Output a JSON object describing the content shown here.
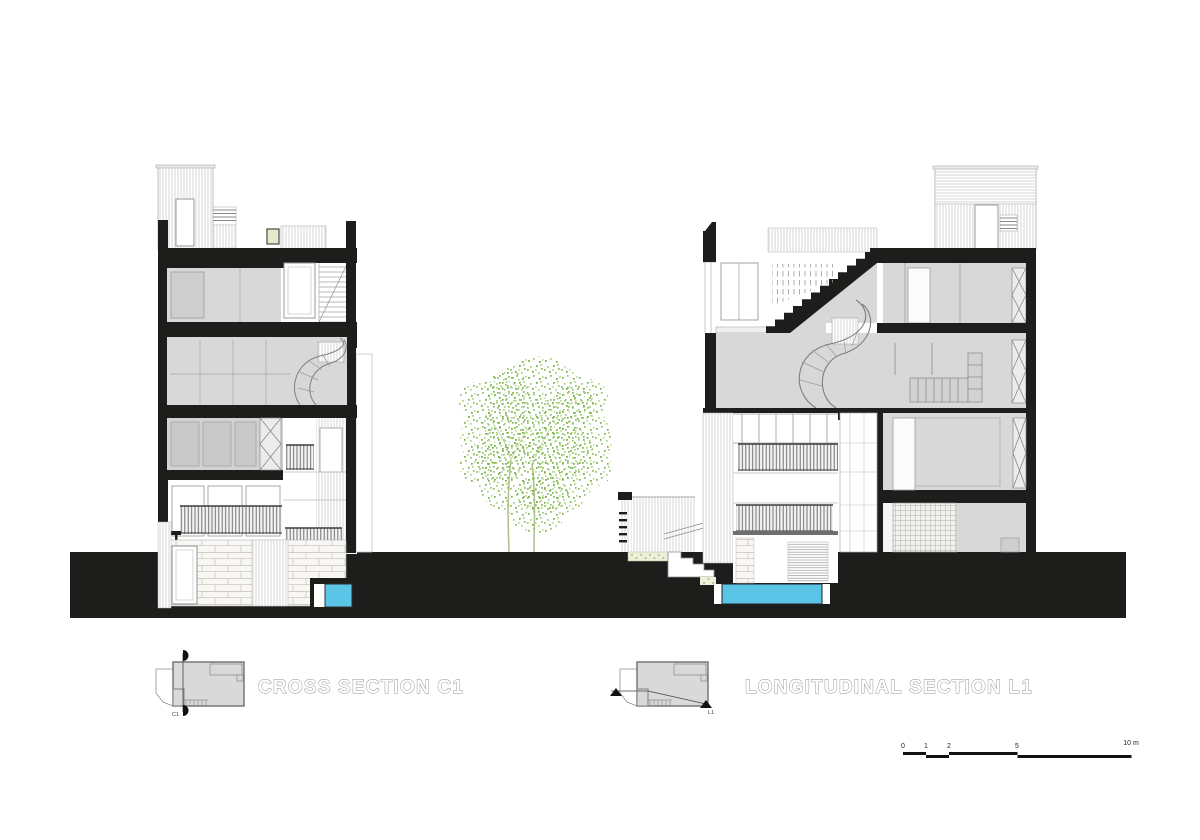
{
  "titles": {
    "cross_section": "CROSS SECTION C1",
    "longitudinal_section": "LONGITUDINAL SECTION L1"
  },
  "key_plans": {
    "cross_cut_label": "C1",
    "long_cut_label": "L1"
  },
  "scale_bar": {
    "ticks": [
      "0",
      "1",
      "2",
      "5"
    ],
    "end_label": "10 m"
  },
  "colors": {
    "poche_black": "#1d1d1b",
    "room_gray": "#d8d8d8",
    "pool_blue": "#5bc5e8",
    "tree_green": "#79b447",
    "stone_joint": "#c6c1b7",
    "label_outline": "#8f8f8f",
    "background": "#ffffff"
  }
}
